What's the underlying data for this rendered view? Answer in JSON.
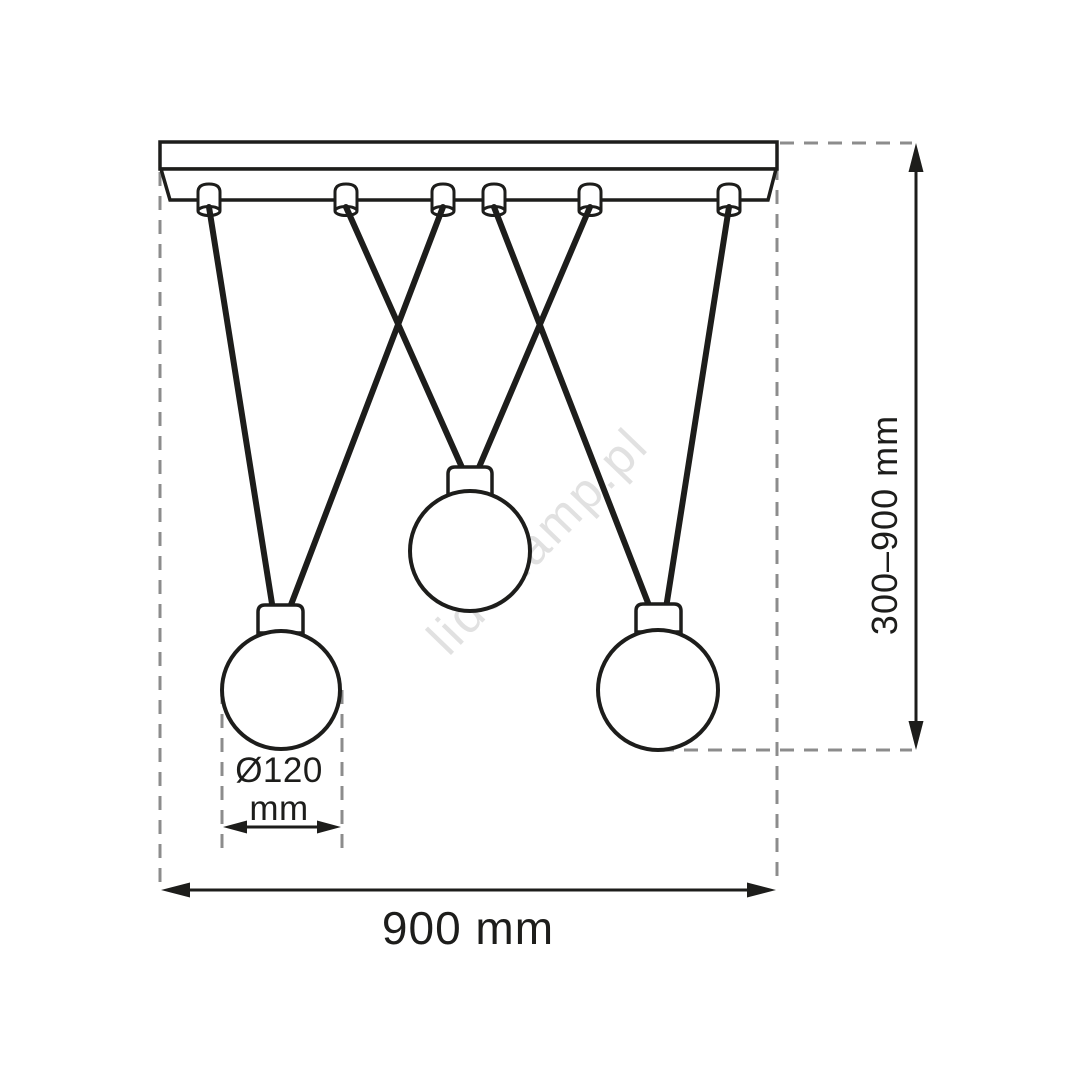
{
  "drawing": {
    "title": "Pendant lamp dimensional diagram",
    "watermark": "liderlamp.pl",
    "labels": {
      "total_width": "900 mm",
      "hanging_height": "300–900 mm",
      "bulb_diameter_line1": "Ø120",
      "bulb_diameter_line2": "mm"
    },
    "counts": {
      "bulbs": 3,
      "suspension_grommets": 6,
      "cords": 6
    },
    "colors": {
      "line": "#1d1d1b",
      "guide_dashed": "#8c8c8c",
      "watermark": "#e1e1e1",
      "background": "#ffffff"
    }
  }
}
